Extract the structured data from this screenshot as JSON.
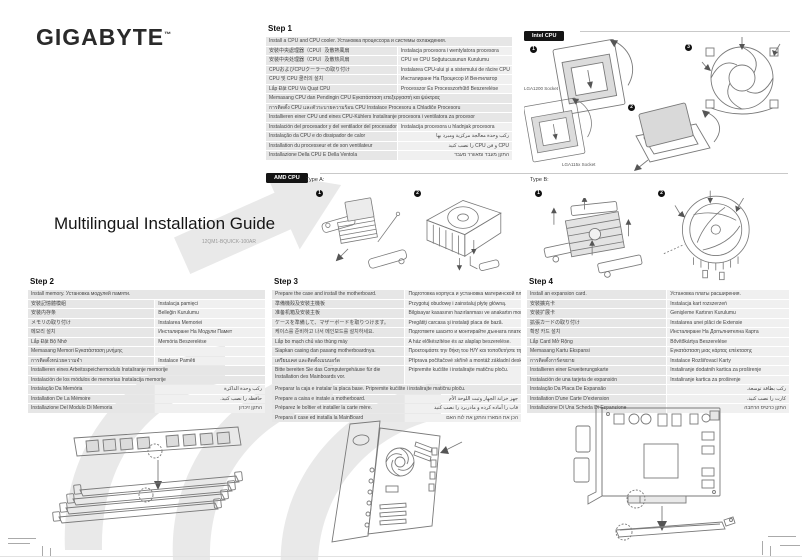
{
  "page": {
    "brand": "GIGABYTE",
    "brand_tm": "™",
    "title": "Multilingual Installation Guide",
    "doc_code": "12QM1-BQUICK-100AR"
  },
  "intel": {
    "label": "Intel CPU",
    "socket_a": "LGA1200 Socket",
    "socket_b": "LGA115x Socket",
    "markers": [
      "1",
      "2",
      "3"
    ]
  },
  "amd": {
    "label": "AMD CPU",
    "type_a": "Type A:",
    "type_b": "Type B:",
    "markers_a": [
      "1",
      "2"
    ],
    "markers_b": [
      "1",
      "2"
    ]
  },
  "step1": {
    "label": "Step 1",
    "rows": [
      {
        "t": "Install a CPU and CPU cooler. Установка процессора и системы охлаждения.",
        "span": true
      },
      {
        "l": "安裝中央處理器（CPU）及散熱風扇",
        "r": "Instalacja procesora i wentylatora procesora"
      },
      {
        "l": "安装中央处理器（CPU）及散热风扇",
        "r": "CPU ve CPU Soğutucusunun Kurulumu"
      },
      {
        "l": "CPUおよびCPUクーラーの取り付け",
        "r": "Instalarea CPU-ului şi a sistemului de răcire CPU"
      },
      {
        "l": "CPU 및 CPU 쿨러의 설치",
        "r": "Инсталиране На Процесор И Вентилатор"
      },
      {
        "l": "Lắp Đặt CPU Và Quạt CPU",
        "r": "Processzor És Processzorhűtő Beszerelése"
      },
      {
        "t": "Memasang CPU dan Pendingin CPU Εγκατάσταση επεξεργαστή και ψύκτρας",
        "span": true
      },
      {
        "t": "การติดตั้ง CPU และตัวระบายความร้อน CPU Instalace Procesoru a Chladiče Procesoru",
        "span": true
      },
      {
        "t": "Installieren einer CPU und eines CPU-Kühlers Instaliranje procesora i ventilatora za procesor",
        "span": true
      },
      {
        "l": "Instalación del procesador y del ventilador del procesador",
        "r": "Instalacija procesora u hladnjak procesora"
      },
      {
        "l": "Instalação da CPU e do dissipador de calor",
        "r": "ركب وحدة معالجة مركزية ومبرد بها",
        "rtl": true
      },
      {
        "l": "Installation du processeur et de son ventilateur",
        "r": "CPU و فن CPU را نصب كنيد",
        "rtl": true
      },
      {
        "l": "Installazione Della CPU E Della Ventola",
        "r": "התקן מעבד ומאוורר מעבד",
        "rtl": true
      }
    ]
  },
  "step2": {
    "label": "Step 2",
    "rows": [
      {
        "t": "Install memory. Установка модулей памяти.",
        "span": true
      },
      {
        "l": "安裝記憶體模組",
        "r": "Instalacja pamięci"
      },
      {
        "l": "安装内存条",
        "r": "Belleğin Kurulumu"
      },
      {
        "l": "メモリの取り付け",
        "r": "Instalarea Memoriei"
      },
      {
        "l": "메모리 설치",
        "r": "Инсталиране На Модули Памет"
      },
      {
        "l": "Lắp Đặt Bộ Nhớ",
        "r": "Memória Beszerelése"
      },
      {
        "l": "Memasang Memori Εγκατάσταση μνήμης",
        "r": ""
      },
      {
        "l": "การติดตั้งหน่วยความจำ",
        "r": "Instalace Paměti"
      },
      {
        "t": "Installieren eines Arbeitsspeichermoduls Instaliranje memorije",
        "span": true
      },
      {
        "t": "Instalación de los módulos de memorias Instalacija memorije",
        "span": true
      },
      {
        "l": "Instalação Da Memória",
        "r": "ركب وحدة الذاكرة",
        "rtl": true
      },
      {
        "l": "Installation De La Mémoire",
        "r": "حافظه را نصب كنيد.",
        "rtl": true
      },
      {
        "l": "Installazione Del Modulo Di Memoria",
        "r": "התקן זיכרון",
        "rtl": true
      }
    ]
  },
  "step3": {
    "label": "Step 3",
    "rows": [
      {
        "l": "Prepare the case and install the motherboard.",
        "r": "Подготовка корпуса и установка материнской платы."
      },
      {
        "l": "準備機殼及安裝主機板",
        "r": "Przygotuj obudowę i zainstaluj płytę główną."
      },
      {
        "l": "准备机箱及安装主板",
        "r": "Bilgisayar kasasının hazırlanması ve anakartın montajı."
      },
      {
        "l": "ケースを準備して、マザーボードを取りつけます。",
        "r": "Pregătiţi carcasa şi instalaţi placa de bază."
      },
      {
        "l": "케이스를 준비하고 나서 메인보드를 설치하세요.",
        "r": "Подгответе шасито и монтирайте дънната платка."
      },
      {
        "l": "Lắp bo mạch chủ vào thùng máy",
        "r": "A ház előkészítése és az alaplap beszerelése."
      },
      {
        "l": "Siapkan casing dan pasang motherboardnya.",
        "r": "Προετοιμάστε την θήκη του Η/Υ και τοποθετήστε τη μητρική"
      },
      {
        "l": "เตรียมเคส และติดตั้งเมนบอร์ด",
        "r": "Příprava počítačové skříně a montáž základní desky."
      },
      {
        "l": "Bitte bereiten Sie das Computergehäuse für die Installation des Mainboards vor.",
        "r": "Pripremite kućište i instalirajte matičnu ploču.",
        "wrap": true
      },
      {
        "t": "Preparar la caja e instalar la placa base. Pripremite kućište i instalirajte matičnu ploču.",
        "span": true
      },
      {
        "l": "Prepare a caixa e instale a motherboard.",
        "r": "جهز خزانة الجهاز وثبت اللوحة الأم",
        "rtl": true
      },
      {
        "l": "Préparez le boîtier et installer la carte mère.",
        "r": "قاب را آماده كرده و مادربرد را نصب كنيد",
        "rtl": true
      },
      {
        "l": "Prepara il case ed installa la MainBoard",
        "r": "הכן את המארז והתקן את לוח האם",
        "rtl": true
      }
    ]
  },
  "step4": {
    "label": "Step 4",
    "rows": [
      {
        "l": "Install an expansion card.",
        "r": "Установка платы расширения."
      },
      {
        "l": "安裝擴充卡",
        "r": "Instalacja kart rozszerzeń"
      },
      {
        "l": "安装扩展卡",
        "r": "Genişleme Kartının Kurulumu"
      },
      {
        "l": "拡張カードの取り付け",
        "r": "Instalarea unei plăci de Extensie"
      },
      {
        "l": "확장 카드 설치",
        "r": "Инсталиране На Допълнителна Карта"
      },
      {
        "l": "Lắp Card Mở Rộng",
        "r": "Bővítőkártya Beszerelése"
      },
      {
        "l": "Memasang Kartu Ekspansi",
        "r": "Εγκατάσταση μιας κάρτας επέκτασης"
      },
      {
        "l": "การติดตั้งการ์ดขยาย",
        "r": "Instalace Rozšiřovací Karty"
      },
      {
        "l": "Installieren einer Erweiterungskarte",
        "r": "Instaliranje dodatnih kartica za proširenje"
      },
      {
        "l": "Instalación de una tarjeta de expansión",
        "r": "Instaliranje kartica za proširenje"
      },
      {
        "l": "Instalação Da Placa De Expansão",
        "r": "ركب بطاقة توسعة.",
        "rtl": true
      },
      {
        "l": "Installation D'une Carte D'extension",
        "r": "كارت را نصب كنيد.",
        "rtl": true
      },
      {
        "l": "Installazione Di Una Scheda Di Espansione",
        "r": "התקן כרטיס הרחבה",
        "rtl": true
      }
    ]
  }
}
